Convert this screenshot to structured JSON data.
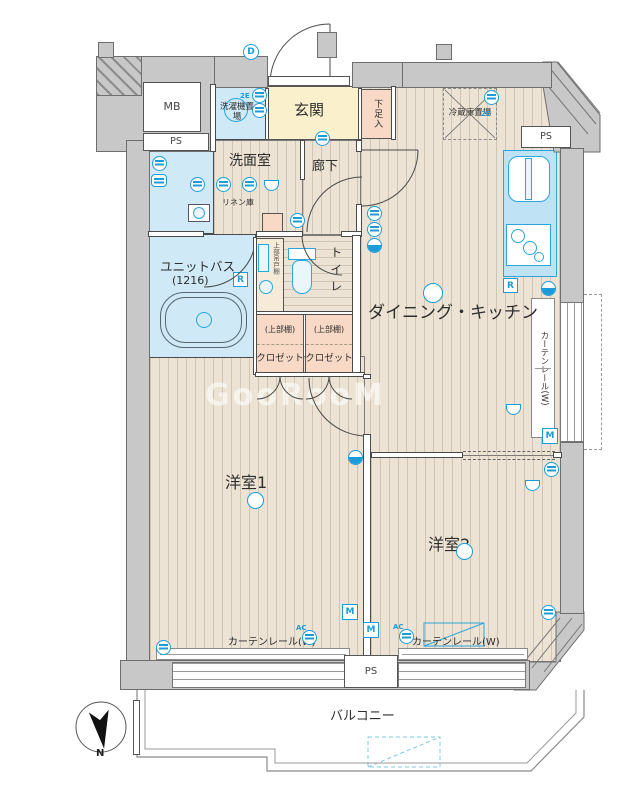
{
  "labels": {
    "mb": "MB",
    "ps": "PS",
    "genkan": "玄関",
    "shoe_box": "下足入",
    "washer": "洗濯機置場",
    "fridge": "冷蔵庫置場",
    "senmenshitsu": "洗面室",
    "rouka": "廊下",
    "linen": "リネン庫",
    "unit_bath": "ユニットバス",
    "unit_bath_size": "(1216)",
    "hanging_cabinet": "上部吊戸棚",
    "toilet": "トイレ",
    "upper_shelf": "(上部棚)",
    "closet": "クロゼット",
    "dk": "ダイニング・キッチン",
    "curtain_rail": "カーテンレール(W)",
    "room1": "洋室1",
    "room2": "洋室2",
    "balcony": "バルコニー",
    "north": "N"
  },
  "markers": {
    "door": "D",
    "range": "R",
    "meter": "M",
    "ac": "AC",
    "outlet_2e": "2E"
  },
  "watermark": {
    "text": "GooRooM"
  },
  "colors": {
    "icon_blue": "#1b9cd8",
    "wall_gray": "#c8c8c8",
    "genkan_yellow": "#faf1cc",
    "closet_pink": "#f7d9c5",
    "bath_blue": "#cfe9f6",
    "floor_beige": "#ece3d4"
  }
}
